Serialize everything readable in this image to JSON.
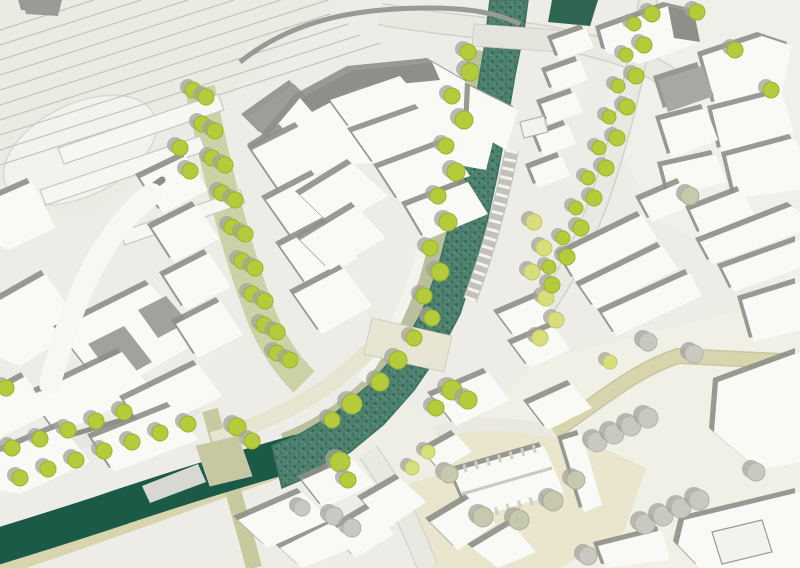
{
  "scene": {
    "kind": "architectural-masterplan-site-plan"
  },
  "palette": {
    "background": "#edece7",
    "building": "#f9f9f6",
    "building_shadow": "#8f8f8a",
    "roof_gray": "#a2a29d",
    "river": "#4d806e",
    "river_edge": "#3f7260",
    "canal": "#1c5a48",
    "bank_olive": "#b9c09b",
    "boulevard_olive": "#cdd2a6",
    "khaki_road": "#d8d5ae",
    "cream": "#eae6ce",
    "road_fill": "#e9e9e2",
    "road_edge": "#d3d3cb",
    "tree_green": "#b4cc3c",
    "tree_pale": "#c9c9c2",
    "tree_sage": "#c6c9ae",
    "tree_yellow": "#d9de7d",
    "tree_shadow": "#a3a39d",
    "rail_line": "#c5c5be"
  },
  "map": {
    "width": 800,
    "height": 568,
    "background": "#edece7",
    "patches": [
      {
        "p": "0,0 340,0 96,212 0,212",
        "f": "#ebebe3",
        "n": "rail-yard-ground"
      },
      {
        "p": "640,0 800,0 800,300 660,220 600,120",
        "f": "#f0efe9",
        "n": "old-town-ground"
      },
      {
        "p": "540,360 800,296 800,568 430,568 468,428",
        "f": "#f1f0e6",
        "n": "south-plaza-ground"
      },
      {
        "p": "402,442 468,416 560,428 646,468 624,532 560,568 432,568 396,492",
        "f": "#eae6ce",
        "n": "churchyard-ground"
      },
      {
        "p": "318,428 386,398 448,424 436,476 366,496 316,464",
        "f": "#efeee4",
        "n": "junction-plaza"
      },
      {
        "ellipse": true,
        "cx": 80,
        "cy": 150,
        "rx": 82,
        "ry": 46,
        "rot": -26,
        "f": "#f3f3ee",
        "s": "#d9d9d1",
        "n": "station-forecourt-oval"
      }
    ],
    "railway": {
      "color": "#c5c5be",
      "lines": [
        [
          0,
          30,
          94,
          0
        ],
        [
          0,
          45,
          141,
          0
        ],
        [
          0,
          60,
          188,
          0
        ],
        [
          0,
          75,
          234,
          0
        ],
        [
          0,
          90,
          281,
          0
        ],
        [
          0,
          105,
          328,
          0
        ],
        [
          0,
          120,
          330,
          14
        ],
        [
          0,
          135,
          348,
          24
        ],
        [
          0,
          150,
          360,
          35
        ],
        [
          0,
          165,
          380,
          43
        ]
      ]
    },
    "roads": [
      {
        "d": "M 380,14 C 445,26 505,28 565,40 C 614,50 648,62 672,80",
        "w": 20,
        "fill": "#e9e9e2",
        "edge": "#d3d3cb",
        "n": "top-road"
      },
      {
        "d": "M 649,-6 C 639,60 623,130 601,195 C 581,250 559,290 536,320",
        "w": 17,
        "fill": "#e9e9e2",
        "edge": "#d2d2ca",
        "n": "northeast-street"
      },
      {
        "d": "M 200,88 C 216,170 236,250 262,318 C 273,344 286,364 304,382",
        "w": 30,
        "fill": "#cdd2a6",
        "n": "tree-boulevard"
      },
      {
        "d": "M 477,50 C 463,122 448,200 426,278 C 413,315 397,348 372,384 C 346,410 316,430 284,442",
        "w": 18,
        "fill": "#b9c09b",
        "n": "riverbank-green"
      },
      {
        "d": "M 464,48 C 452,120 436,198 415,276 C 402,312 386,346 361,380",
        "w": 10,
        "fill": "#f3f3ee",
        "n": "riverside-path"
      },
      {
        "d": "M 0,456 L 196,398",
        "w": 5,
        "fill": "#8f8f8a",
        "n": "street-edge"
      },
      {
        "d": "M 0,466 L 198,408",
        "w": 13,
        "fill": "#e6e6de",
        "n": "southwest-street"
      },
      {
        "d": "M -8,568 C 60,545 150,514 230,484 C 270,470 310,456 348,442",
        "w": 22,
        "fill": "#d8d5ae",
        "n": "canal-south-bank"
      },
      {
        "d": "M 368,452 C 392,484 410,522 428,568",
        "w": 19,
        "fill": "#e9e9e2",
        "edge": "#d6d6ce",
        "n": "south-road"
      },
      {
        "d": "M 436,432 C 478,420 518,424 558,432",
        "w": 13,
        "fill": "#e9e9e2",
        "n": "junction-east-road"
      },
      {
        "d": "M 554,432 C 606,396 636,370 678,356 L 802,362",
        "w": 13,
        "fill": "#d8d5ae",
        "edge": "#c9c6a0",
        "n": "east-khaki-road"
      },
      {
        "d": "M 210,410 C 224,462 240,512 254,568",
        "w": 16,
        "fill": "#c7ca9f",
        "n": "canal-cross-road"
      },
      {
        "d": "M 372,348 C 340,380 310,400 270,418 C 250,427 230,435 212,440",
        "w": 16,
        "fill": "#e7e4cf",
        "n": "bridge-approach-road"
      }
    ],
    "water": {
      "river_points": "490,0 484,50 475,105 464,160 452,215 438,268 422,312 400,350 368,386 334,414 300,434 272,446 282,488 315,474 350,452 384,424 414,390 440,352 460,314 474,270 487,222 497,176 506,128 515,75 524,30 528,0",
      "river_edge": "#3f7260",
      "canal": {
        "d": "M 300,452 C 235,470 165,492 100,514 C 60,527 25,538 -8,548",
        "w": 36,
        "c": "#1c5a48"
      },
      "pool_points": "552,0 598,0 590,26 548,22",
      "pool_fill": "#2e6653"
    },
    "strokes_pre": [
      {
        "d": "M 512,150 C 502,200 488,252 470,300",
        "w": 14,
        "c": "#c2c2bb",
        "n": "river-steps-base"
      },
      {
        "d": "M 512,150 C 502,200 488,252 470,300",
        "w": 12,
        "c": "#f3f3ef",
        "dash": "3 6",
        "n": "river-steps"
      }
    ],
    "bridges": [
      {
        "p": "474,24 560,30 558,52 472,46",
        "f": "#e4e4dc",
        "n": "north-bridge"
      },
      {
        "p": "372,318 452,336 444,372 364,354",
        "f": "#e8e5d2",
        "n": "central-bridge"
      },
      {
        "p": "196,446 238,436 252,476 210,486",
        "f": "#c6c9a0",
        "n": "canal-bridge"
      }
    ],
    "buildings": [
      {
        "p": "246,118 294,84 312,102 264,136",
        "f": "#9e9e99",
        "n": "station-wing"
      },
      {
        "p": "268,136 300,98 352,70 432,62 470,84 498,122 486,170 430,160 352,164 298,172",
        "n": "station-building"
      },
      {
        "p": "300,98 352,70 432,62 440,80 358,88 312,112",
        "f": "#8f8f8a",
        "ns": true
      },
      {
        "p": "470,86 518,110 506,150 468,128"
      },
      {
        "p": "252,148 284,128 298,144 266,164"
      },
      {
        "p": "22,0 62,0 58,16 26,14",
        "f": "#9b9b96"
      },
      {
        "p": "58,148 218,94 224,110 64,164",
        "f": "#f6f6f2",
        "s": "#c9c9c2",
        "ns": true,
        "n": "platform"
      },
      {
        "p": "40,190 200,136 206,151 46,205",
        "f": "#f6f6f2",
        "s": "#c9c9c2",
        "ns": true,
        "n": "platform"
      },
      {
        "p": "120,232 240,190 245,203 125,245",
        "f": "#f6f6f2",
        "s": "#c9c9c2",
        "ns": true,
        "n": "platform"
      },
      {
        "p": "0,196 32,182 56,228 8,250 0,246"
      },
      {
        "p": "0,300 46,274 82,328 20,366 0,358"
      },
      {
        "p": "58,330 150,284 202,340 108,394"
      },
      {
        "p": "88,344 124,326 152,362 116,382",
        "f": "#a2a29d",
        "ns": true
      },
      {
        "p": "138,310 166,296 188,322 158,338",
        "f": "#a2a29d",
        "ns": true
      },
      {
        "p": "30,396 122,352 152,390 58,434"
      },
      {
        "p": "124,400 198,364 222,396 146,434"
      },
      {
        "p": "0,390 26,376 48,414 0,438"
      },
      {
        "p": "0,452 62,426 90,462 20,494 0,490"
      },
      {
        "p": "92,438 172,406 198,440 114,472"
      },
      {
        "p": "142,486 198,464 206,482 150,503",
        "f": "#d8d8d2",
        "ns": true
      },
      {
        "p": "140,178 186,156 208,190 163,213"
      },
      {
        "p": "152,228 197,205 219,239 174,262"
      },
      {
        "p": "164,276 209,253 231,287 186,310"
      },
      {
        "p": "176,324 221,301 243,335 198,358"
      },
      {
        "p": "252,150 300,126 330,168 282,194"
      },
      {
        "p": "266,200 316,174 344,212 294,240"
      },
      {
        "p": "280,246 330,220 358,258 308,286"
      },
      {
        "p": "294,294 344,268 372,306 322,334"
      },
      {
        "p": "330,100 400,76 424,104 352,130"
      },
      {
        "p": "352,132 420,108 446,140 376,166"
      },
      {
        "p": "378,168 448,142 470,176 400,202"
      },
      {
        "p": "300,195 352,163 388,196 334,228"
      },
      {
        "p": "300,240 356,206 386,238 330,270"
      },
      {
        "p": "406,206 468,182 488,214 426,240"
      },
      {
        "p": "552,40 586,28 594,48 560,60"
      },
      {
        "p": "546,72 580,60 588,80 554,92"
      },
      {
        "p": "541,104 575,92 583,112 549,124"
      },
      {
        "p": "536,136 568,124 576,144 544,156"
      },
      {
        "p": "530,168 562,156 570,176 538,188"
      },
      {
        "p": "600,30 668,6 694,12 700,42 640,64 606,52"
      },
      {
        "p": "668,6 694,12 700,42 674,38",
        "f": "#8f8f8a",
        "ns": true
      },
      {
        "p": "702,56 762,36 792,46 782,92 716,106"
      },
      {
        "p": "658,80 702,66 714,96 668,112",
        "f": "#a8a8a3"
      },
      {
        "p": "712,110 782,92 794,132 722,152"
      },
      {
        "p": "660,120 706,108 718,140 672,158"
      },
      {
        "p": "726,156 794,138 800,148 800,190 736,198"
      },
      {
        "p": "662,166 716,154 726,182 670,197"
      },
      {
        "p": "640,200 682,182 694,204 652,222"
      },
      {
        "p": "690,210 742,190 754,214 702,236"
      },
      {
        "p": "700,242 792,206 800,212 800,232 712,264"
      },
      {
        "p": "560,255 642,215 658,240 576,281"
      },
      {
        "p": "580,286 662,246 678,269 596,309"
      },
      {
        "p": "602,313 690,273 702,296 617,336"
      },
      {
        "p": "722,268 800,240 800,268 734,292"
      },
      {
        "p": "742,300 800,282 800,330 754,342"
      },
      {
        "p": "718,382 800,352 800,462 758,470 714,432"
      },
      {
        "p": "562,440 582,434 602,505 584,512"
      },
      {
        "p": "684,520 800,492 800,568 700,568 678,545"
      },
      {
        "p": "712,532 762,520 772,552 722,564",
        "f": "#f2f2ee",
        "s": "#9a9a95",
        "ns": true,
        "n": "courtyard"
      },
      {
        "p": "598,546 662,530 670,560 606,568"
      },
      {
        "p": "452,472 544,446 564,492 472,518",
        "n": "church"
      },
      {
        "p": "424,452 456,434 472,452 440,470"
      },
      {
        "p": "432,396 488,372 510,400 456,426"
      },
      {
        "p": "528,404 572,384 592,408 548,430"
      },
      {
        "p": "498,314 540,296 558,320 516,338"
      },
      {
        "p": "512,344 554,326 570,350 530,368"
      },
      {
        "p": "362,500 400,478 426,502 388,528"
      },
      {
        "p": "330,532 370,508 394,534 356,558"
      },
      {
        "p": "430,522 470,498 496,524 458,550"
      },
      {
        "p": "472,548 512,524 536,552 498,568"
      },
      {
        "p": "280,548 332,522 352,548 302,568"
      },
      {
        "p": "238,520 302,492 330,520 268,548"
      },
      {
        "p": "302,480 352,458 374,484 324,508"
      },
      {
        "p": "520,122 544,116 548,132 524,138",
        "f": "#f2f2ee",
        "s": "#b5b5af",
        "ns": true,
        "n": "river-jetty"
      }
    ],
    "strokes_post": [
      {
        "d": "M 162,180 C 112,214 72,280 42,388",
        "w": 7,
        "c": "#8d8d88",
        "cap": "round",
        "n": "curved-building-shadow"
      },
      {
        "d": "M 152,194 C 108,228 76,286 50,384",
        "w": 22,
        "c": "#f7f7f4",
        "cap": "round",
        "n": "curved-building"
      },
      {
        "d": "M 240,62 C 290,22 350,8 430,8 C 470,8 500,14 520,24",
        "w": 5,
        "c": "#9a9a95",
        "n": "station-road-edge"
      },
      {
        "d": "M 462,494 L 552,468",
        "w": 3,
        "c": "#c9c9c3",
        "n": "church-ridge"
      },
      {
        "d": "M 452,472 L 544,446",
        "w": 8,
        "c": "#cfcfc8",
        "dash": "3 9",
        "n": "church-buttresses-north"
      },
      {
        "d": "M 472,518 L 564,492",
        "w": 8,
        "c": "#cfcfc8",
        "dash": "3 9",
        "n": "church-buttresses-south"
      }
    ],
    "trees": {
      "shadow_offset": [
        -5,
        -3
      ],
      "pale": [
        [
          597,
          442,
          10
        ],
        [
          614,
          434,
          10
        ],
        [
          631,
          426,
          10
        ],
        [
          648,
          418,
          10
        ],
        [
          645,
          524,
          10
        ],
        [
          663,
          516,
          10
        ],
        [
          681,
          508,
          10
        ],
        [
          699,
          500,
          10
        ],
        [
          756,
          472,
          9
        ],
        [
          588,
          556,
          9
        ],
        [
          648,
          342,
          9
        ],
        [
          694,
          354,
          9
        ],
        [
          334,
          516,
          9
        ],
        [
          352,
          528,
          9
        ],
        [
          302,
          508,
          8
        ]
      ],
      "sage": [
        [
          483,
          517,
          10
        ],
        [
          519,
          520,
          10
        ],
        [
          553,
          501,
          10
        ],
        [
          449,
          474,
          9
        ],
        [
          576,
          480,
          9
        ],
        [
          690,
          196,
          9
        ]
      ],
      "yellow": [
        [
          534,
          222,
          8
        ],
        [
          544,
          248,
          8
        ],
        [
          532,
          272,
          8
        ],
        [
          546,
          298,
          8
        ],
        [
          556,
          320,
          8
        ],
        [
          540,
          338,
          8
        ],
        [
          428,
          452,
          7
        ],
        [
          412,
          468,
          7
        ],
        [
          610,
          362,
          7
        ]
      ],
      "green": [
        [
          193,
          90,
          8
        ],
        [
          206,
          97,
          8
        ],
        [
          202,
          124,
          8
        ],
        [
          215,
          131,
          8
        ],
        [
          212,
          158,
          8
        ],
        [
          225,
          165,
          8
        ],
        [
          222,
          193,
          8
        ],
        [
          235,
          200,
          8
        ],
        [
          232,
          227,
          8
        ],
        [
          245,
          234,
          8
        ],
        [
          242,
          261,
          8
        ],
        [
          255,
          268,
          8
        ],
        [
          252,
          294,
          8
        ],
        [
          265,
          301,
          8
        ],
        [
          264,
          325,
          8
        ],
        [
          277,
          332,
          8
        ],
        [
          277,
          353,
          8
        ],
        [
          290,
          360,
          8
        ],
        [
          180,
          148,
          8
        ],
        [
          190,
          171,
          8
        ],
        [
          12,
          448,
          8
        ],
        [
          40,
          439,
          8
        ],
        [
          68,
          430,
          8
        ],
        [
          96,
          421,
          8
        ],
        [
          124,
          412,
          8
        ],
        [
          20,
          478,
          8
        ],
        [
          48,
          469,
          8
        ],
        [
          76,
          460,
          8
        ],
        [
          104,
          451,
          8
        ],
        [
          132,
          442,
          8
        ],
        [
          160,
          433,
          8
        ],
        [
          188,
          424,
          8
        ],
        [
          6,
          388,
          8
        ],
        [
          470,
          72,
          9
        ],
        [
          452,
          96,
          8
        ],
        [
          464,
          120,
          9
        ],
        [
          446,
          146,
          8
        ],
        [
          456,
          172,
          9
        ],
        [
          438,
          196,
          8
        ],
        [
          448,
          222,
          9
        ],
        [
          430,
          248,
          8
        ],
        [
          440,
          272,
          9
        ],
        [
          424,
          296,
          8
        ],
        [
          432,
          318,
          8
        ],
        [
          414,
          338,
          8
        ],
        [
          398,
          360,
          9
        ],
        [
          380,
          382,
          9
        ],
        [
          352,
          404,
          10
        ],
        [
          332,
          420,
          8
        ],
        [
          452,
          390,
          10
        ],
        [
          468,
          400,
          9
        ],
        [
          436,
          408,
          8
        ],
        [
          237,
          427,
          9
        ],
        [
          252,
          441,
          8
        ],
        [
          340,
          462,
          10
        ],
        [
          348,
          480,
          8
        ],
        [
          468,
          52,
          8
        ],
        [
          652,
          14,
          8
        ],
        [
          634,
          24,
          7
        ],
        [
          644,
          45,
          8
        ],
        [
          626,
          55,
          7
        ],
        [
          636,
          76,
          8
        ],
        [
          618,
          86,
          7
        ],
        [
          627,
          107,
          8
        ],
        [
          609,
          117,
          7
        ],
        [
          617,
          138,
          8
        ],
        [
          599,
          148,
          7
        ],
        [
          606,
          168,
          8
        ],
        [
          588,
          178,
          7
        ],
        [
          594,
          198,
          8
        ],
        [
          576,
          208,
          7
        ],
        [
          581,
          228,
          8
        ],
        [
          563,
          238,
          7
        ],
        [
          567,
          257,
          8
        ],
        [
          549,
          267,
          7
        ],
        [
          552,
          285,
          8
        ],
        [
          697,
          12,
          8
        ],
        [
          735,
          50,
          8
        ],
        [
          771,
          90,
          8
        ]
      ]
    }
  }
}
